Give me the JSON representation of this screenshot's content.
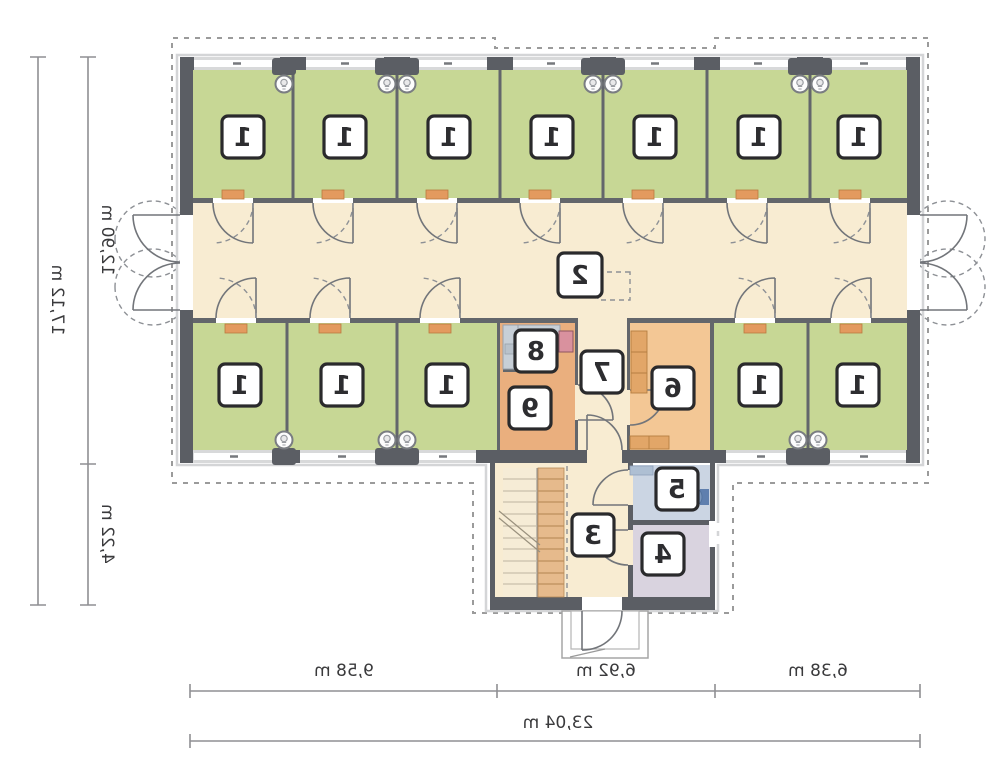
{
  "rooms": {
    "r1": "1",
    "r2": "2",
    "r3": "3",
    "r4": "4",
    "r5": "5",
    "r6": "6",
    "r7": "7",
    "r8": "8",
    "r9": "9"
  },
  "dimensions": {
    "bottom_segments": [
      "9,58 m",
      "6,92 m",
      "6,38 m"
    ],
    "bottom_total": "23,04 m",
    "side_upper": "12,90 m",
    "side_lower": "4,22 m",
    "side_total": "17,12 m"
  },
  "colors": {
    "room_green": "#c7d795",
    "corridor_cream": "#f8ecd2",
    "kitchen_orange": "#f3c795",
    "staff_orange": "#eaaf7e",
    "bath_blue": "#cbd5e3",
    "tech_lavender": "#d9d3df",
    "wall_gray": "#5b5e64",
    "partition_gray": "#63666b",
    "counter_orange": "#e2a668",
    "counter_gray": "#c7cfd7",
    "threshold_orange": "#e39a5f",
    "appliance_pink": "#d9919e"
  },
  "icons": {
    "lamp": "wall-lamp-icon",
    "hatch": "roof-hatch-icon",
    "stairs": "staircase",
    "door": "door-swing-icon",
    "toilet": "toilet-icon"
  }
}
